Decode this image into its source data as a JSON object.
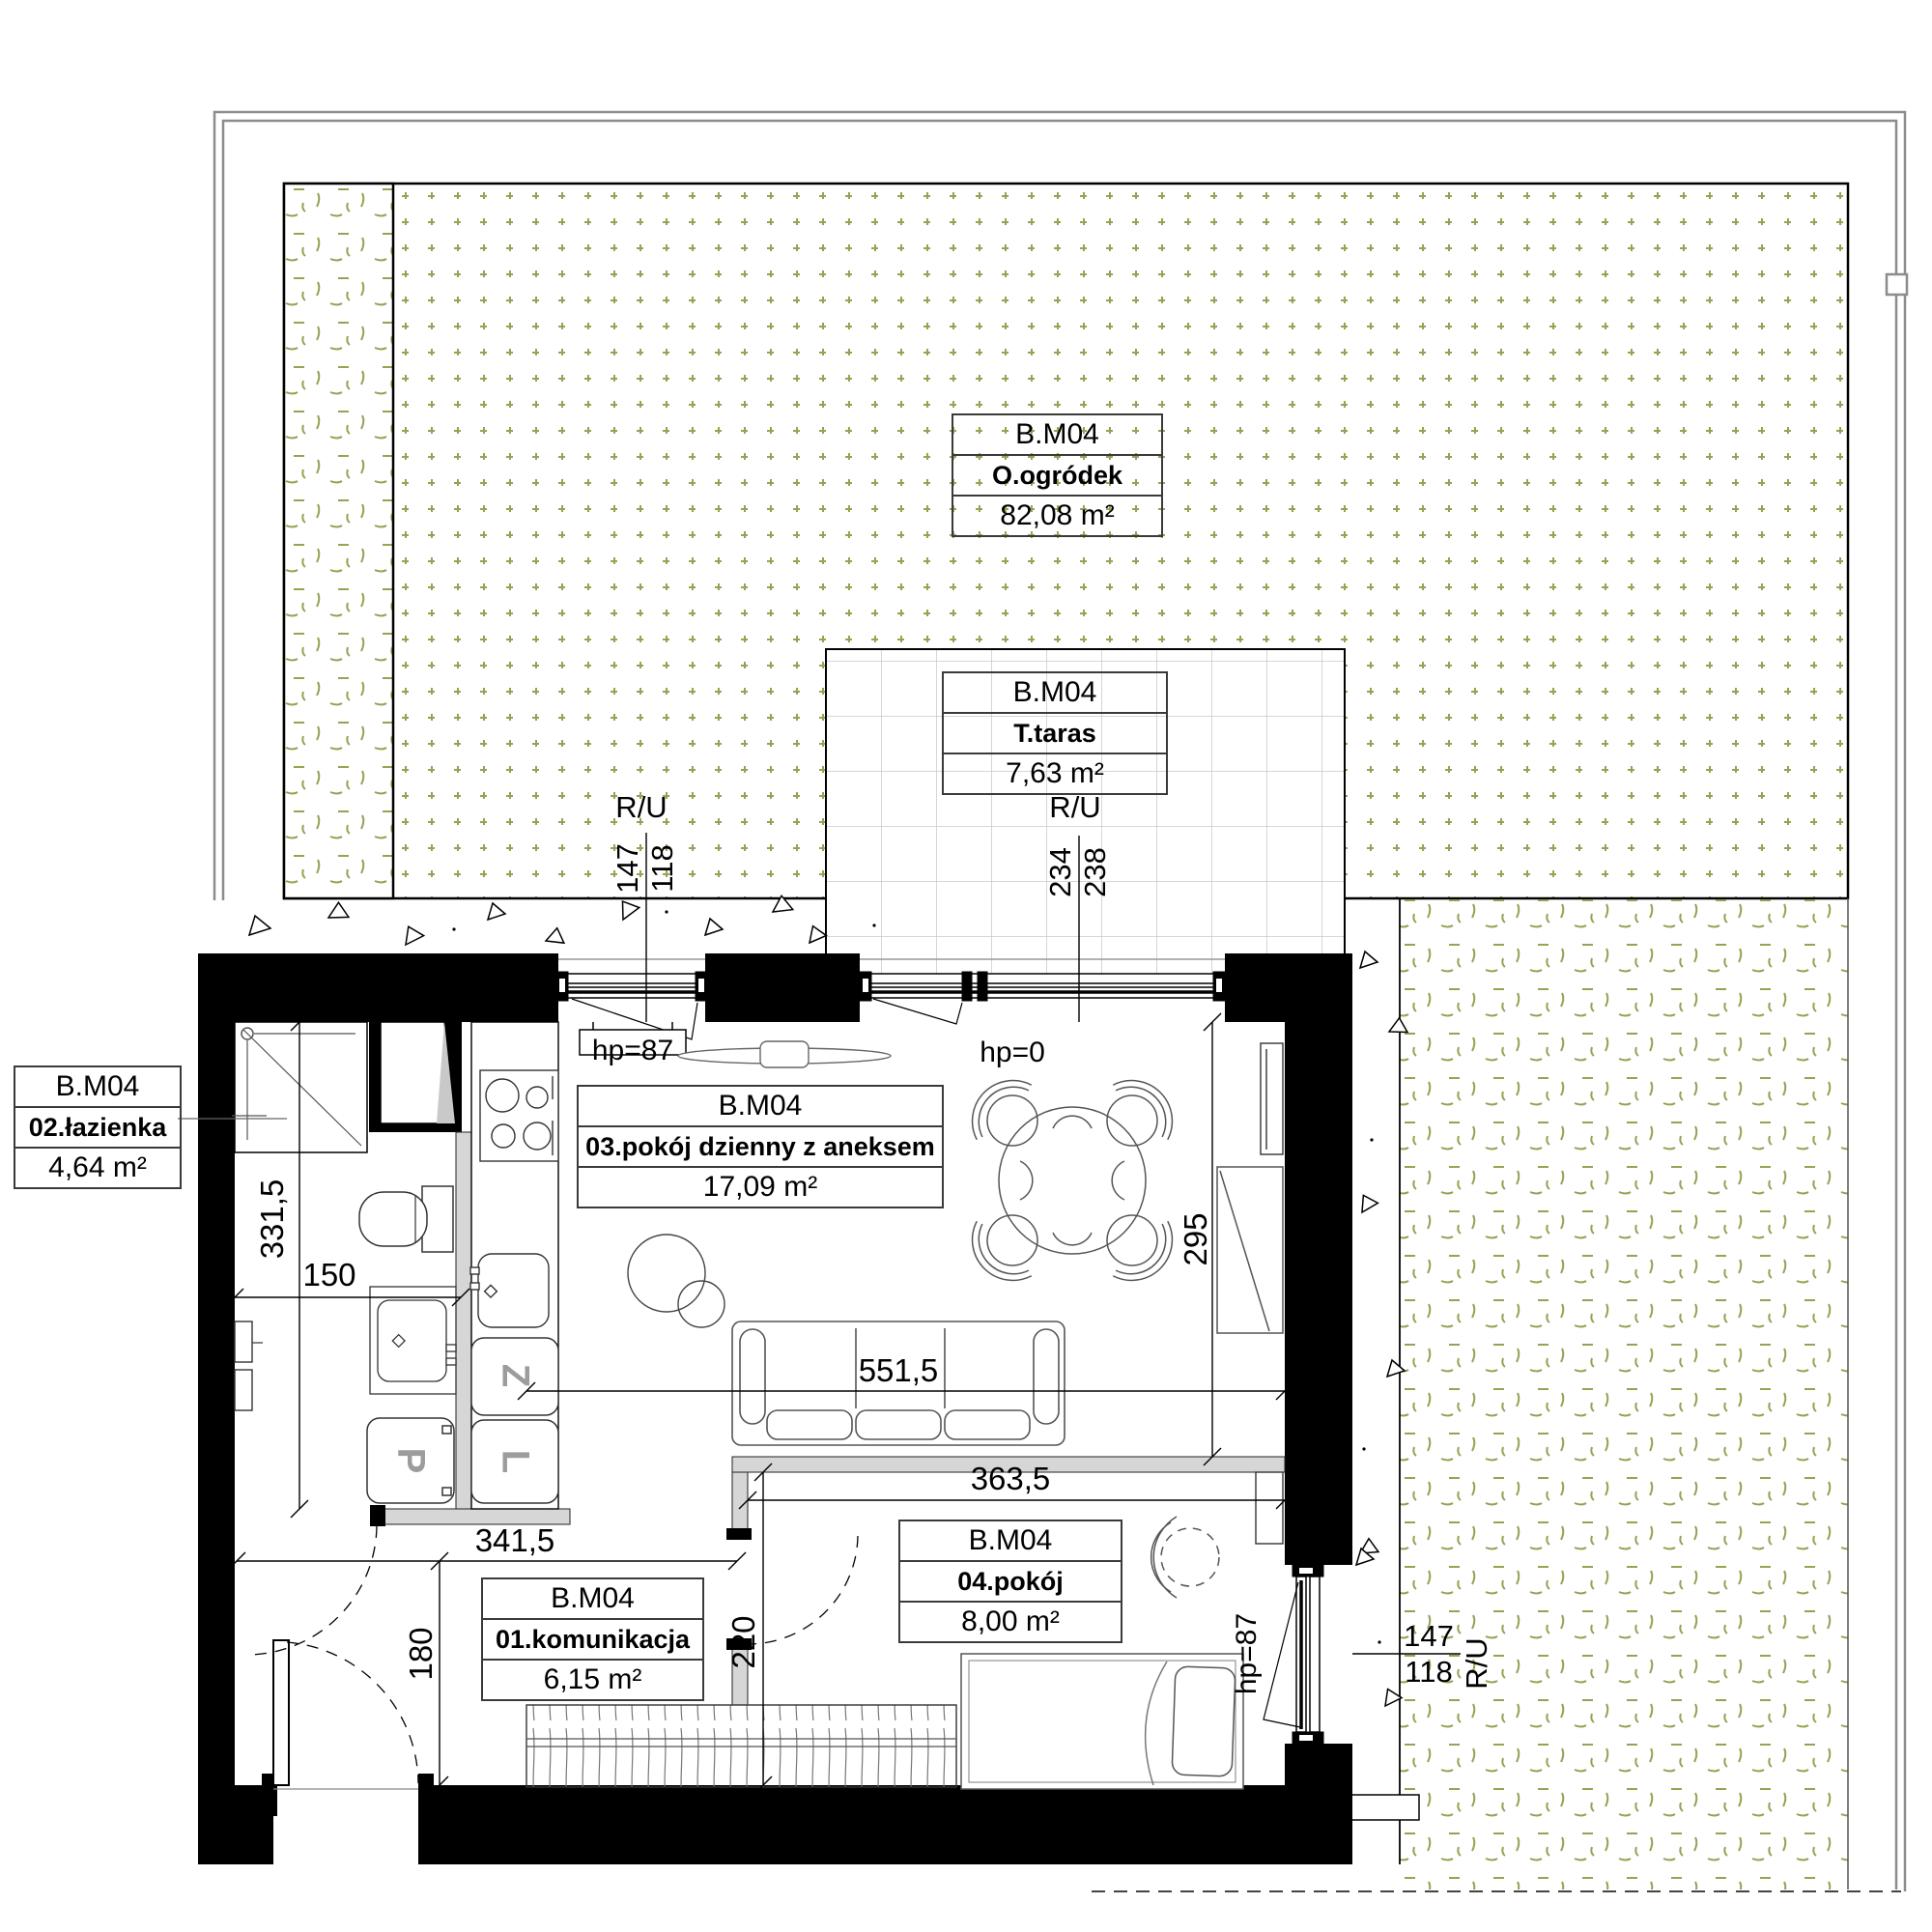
{
  "unit": "B.M04",
  "rooms": {
    "ogrodek": {
      "unit": "B.M04",
      "name": "O.ogródek",
      "area": "82,08 m²"
    },
    "taras": {
      "unit": "B.M04",
      "name": "T.taras",
      "area": "7,63 m²"
    },
    "lazienka": {
      "unit": "B.M04",
      "name": "02.łazienka",
      "area": "4,64 m²"
    },
    "dzienny": {
      "unit": "B.M04",
      "name": "03.pokój dzienny z aneksem",
      "area": "17,09 m²"
    },
    "komunikacja": {
      "unit": "B.M04",
      "name": "01.komunikacja",
      "area": "6,15 m²"
    },
    "pokoj": {
      "unit": "B.M04",
      "name": "04.pokój",
      "area": "8,00 m²"
    }
  },
  "dimensions": {
    "bath_height": "331,5",
    "bath_width": "150",
    "komunikacja_width": "341,5",
    "entry_depth": "180",
    "room_door_depth": "220",
    "living_width": "551,5",
    "room4_width": "363,5",
    "living_height": "295"
  },
  "windows": {
    "kitchen_window": {
      "label": "R/U",
      "over": "147",
      "under": "118",
      "hp": "hp=87"
    },
    "terrace_door": {
      "label": "R/U",
      "over": "234",
      "under": "238",
      "hp": "hp=0"
    },
    "room4_window": {
      "label": "R/U",
      "over": "147",
      "under": "118",
      "hp": "hp=87"
    }
  },
  "appliances": {
    "washing_machine": "P",
    "dishwasher": "Z",
    "fridge": "L"
  },
  "colors": {
    "pattern_green": "#97A254",
    "boundary_gray": "#8C8C8C",
    "partition_gray": "#D6D6D6",
    "tile_gray": "#C8C8C8",
    "wall_black": "#000000"
  }
}
